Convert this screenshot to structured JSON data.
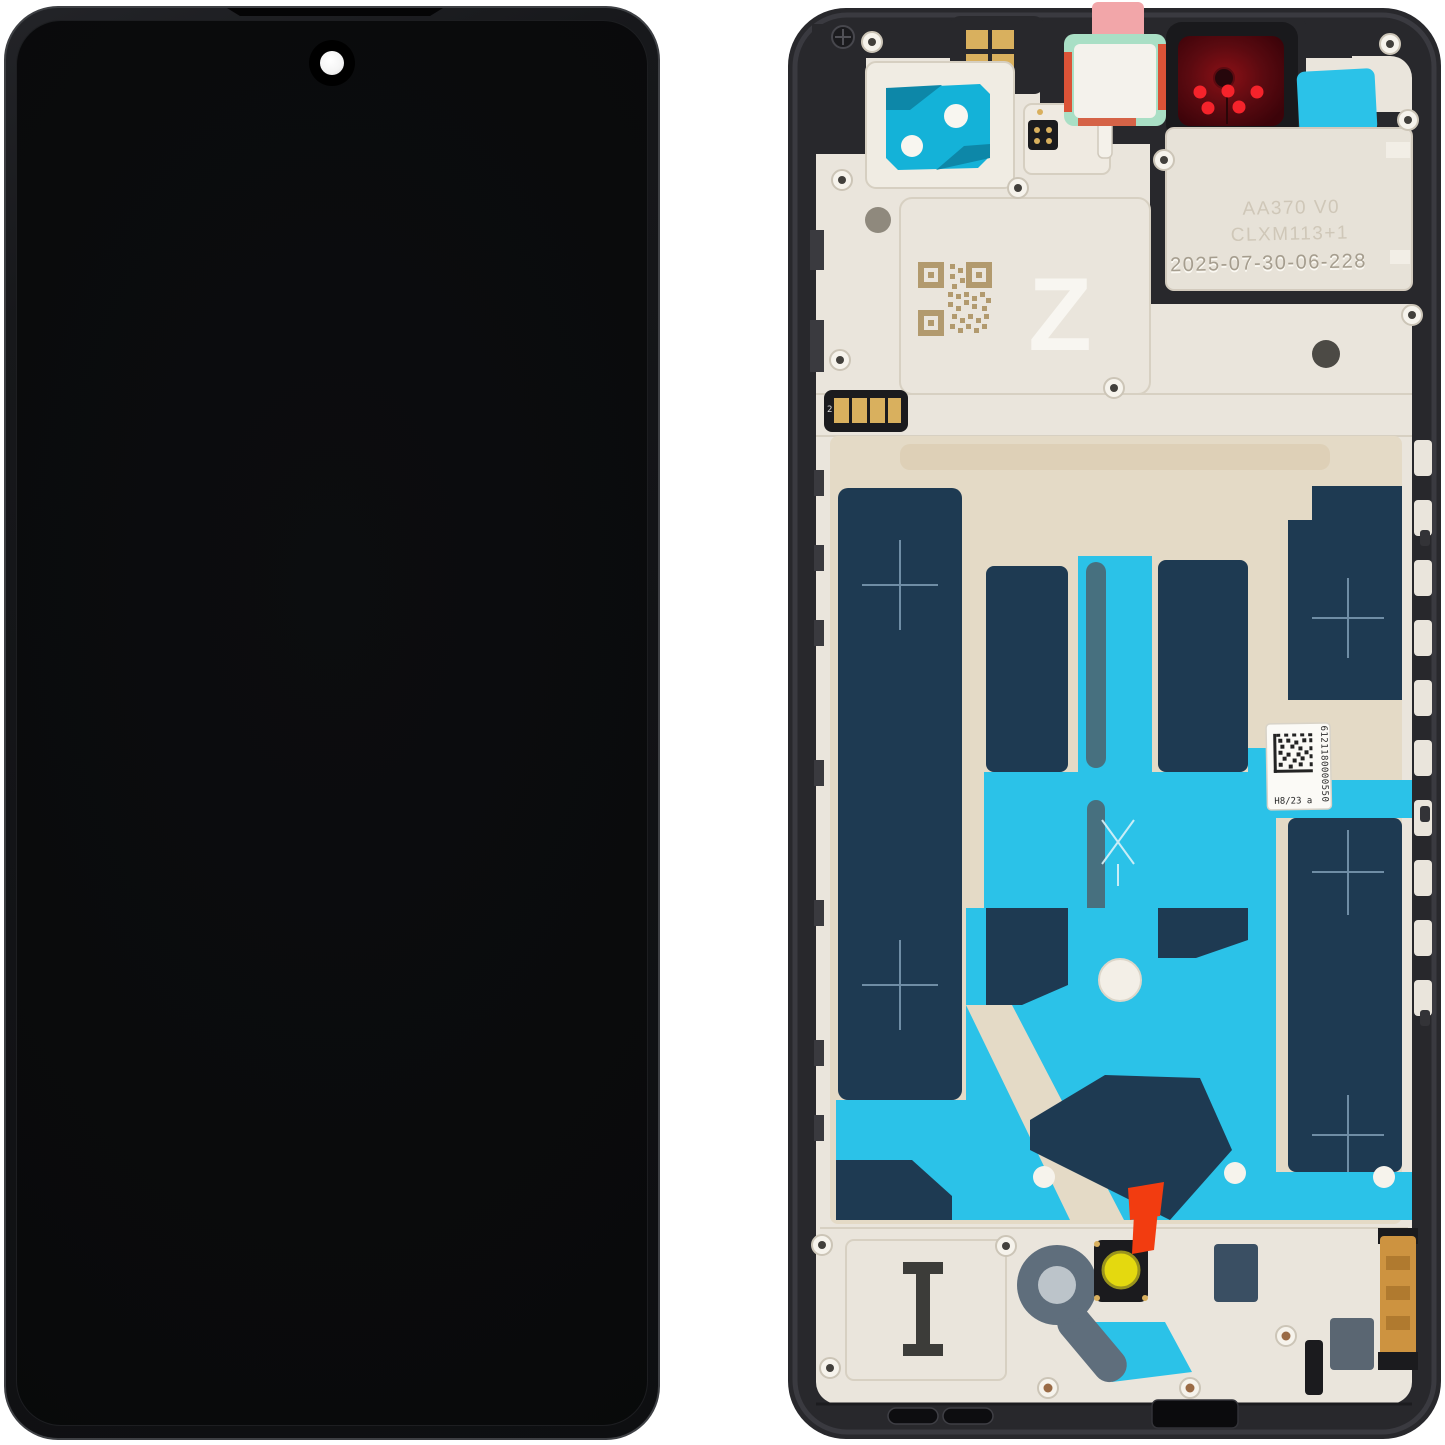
{
  "scene": {
    "description": "Smartphone LCD display assembly with frame, front view (left) and rear view (right)"
  },
  "front_panel": {},
  "rear_panel": {
    "markings": {
      "embossed_line1": "AA370 V0",
      "embossed_line2": "CLXM113+1",
      "embossed_date": "2025-07-30-06-228",
      "letter_mark": "Z",
      "strip_mark": "2"
    },
    "label": {
      "barcode_number": "6121180000550",
      "batch_code": "H8/23 a"
    }
  },
  "colors": {
    "frame-black": "#28282c",
    "plate-cream": "#eae5dc",
    "plate-beige": "#e4dac6",
    "adhesive-navy": "#1e3a52",
    "adhesive-cyan": "#2bc2e8",
    "sticker-teal": "#14b2d8",
    "sticker-mint": "#a9dfc5",
    "sticker-pink": "#f2a6a9",
    "camera-red": "#4f070e",
    "camera-dot-red": "#f5232b",
    "tab-orange": "#f23c10",
    "mic-yellow": "#e4d90f",
    "ring-slate": "#5f6e7c",
    "contact-gold": "#d9b05e",
    "qr-gold": "#b29a6e",
    "screen-black": "#0a0b0c",
    "label-white": "#fbfaf6"
  }
}
